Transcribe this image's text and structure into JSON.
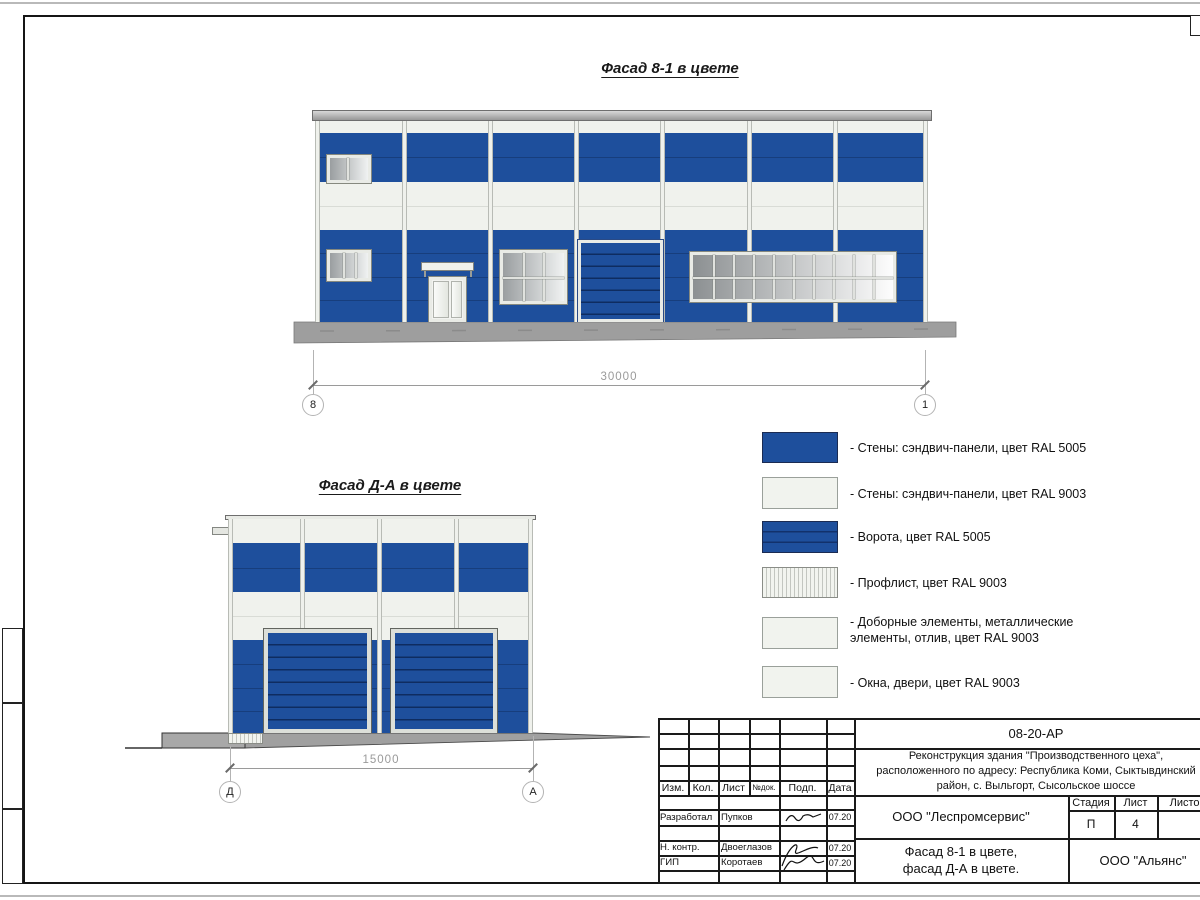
{
  "facade1": {
    "title": "Фасад 8-1 в цвете",
    "dim": "30000",
    "axis_left": "8",
    "axis_right": "1"
  },
  "facade2": {
    "title": "Фасад Д-А в цвете",
    "dim": "15000",
    "axis_left": "Д",
    "axis_right": "А"
  },
  "legend": {
    "items": [
      {
        "label": "- Стены: сэндвич-панели, цвет RAL 5005"
      },
      {
        "label": "- Стены: сэндвич-панели, цвет RAL 9003"
      },
      {
        "label": "- Ворота, цвет RAL 5005"
      },
      {
        "label": "- Профлист, цвет RAL 9003"
      },
      {
        "label": "- Доборные элементы, металлические\nэлементы, отлив, цвет RAL 9003"
      },
      {
        "label": "- Окна, двери, цвет RAL 9003"
      }
    ]
  },
  "title_block": {
    "code": "08-20-АР",
    "project": "Реконструкция здания \"Производственного цеха\",\nрасположенного по адресу: Республика Коми, Сыктывдинский\nрайон, с. Выльгорт, Сысольское шоссе",
    "cols": {
      "izm": "Изм.",
      "kol": "Кол.",
      "list": "Лист",
      "ndok": "№док.",
      "podp": "Подп.",
      "data": "Дата"
    },
    "rows": [
      {
        "role": "Разработал",
        "name": "Пупков",
        "date": "07.20"
      },
      {
        "role": "Н. контр.",
        "name": "Двоеглазов",
        "date": "07.20"
      },
      {
        "role": "ГИП",
        "name": "Коротаев",
        "date": "07.20"
      }
    ],
    "org": "ООО \"Леспромсервис\"",
    "stage_label": "Стадия",
    "list_label": "Лист",
    "listov_label": "Листов",
    "stage": "П",
    "sheet_no": "4",
    "doc_name": "Фасад 8-1 в цвете,\nфасад Д-А в цвете.",
    "company": "ООО \"Альянс\""
  },
  "colors": {
    "ral5005": "#1e4f9c",
    "ral9003": "#f0f2ed",
    "ground": "#9e9e9e"
  }
}
